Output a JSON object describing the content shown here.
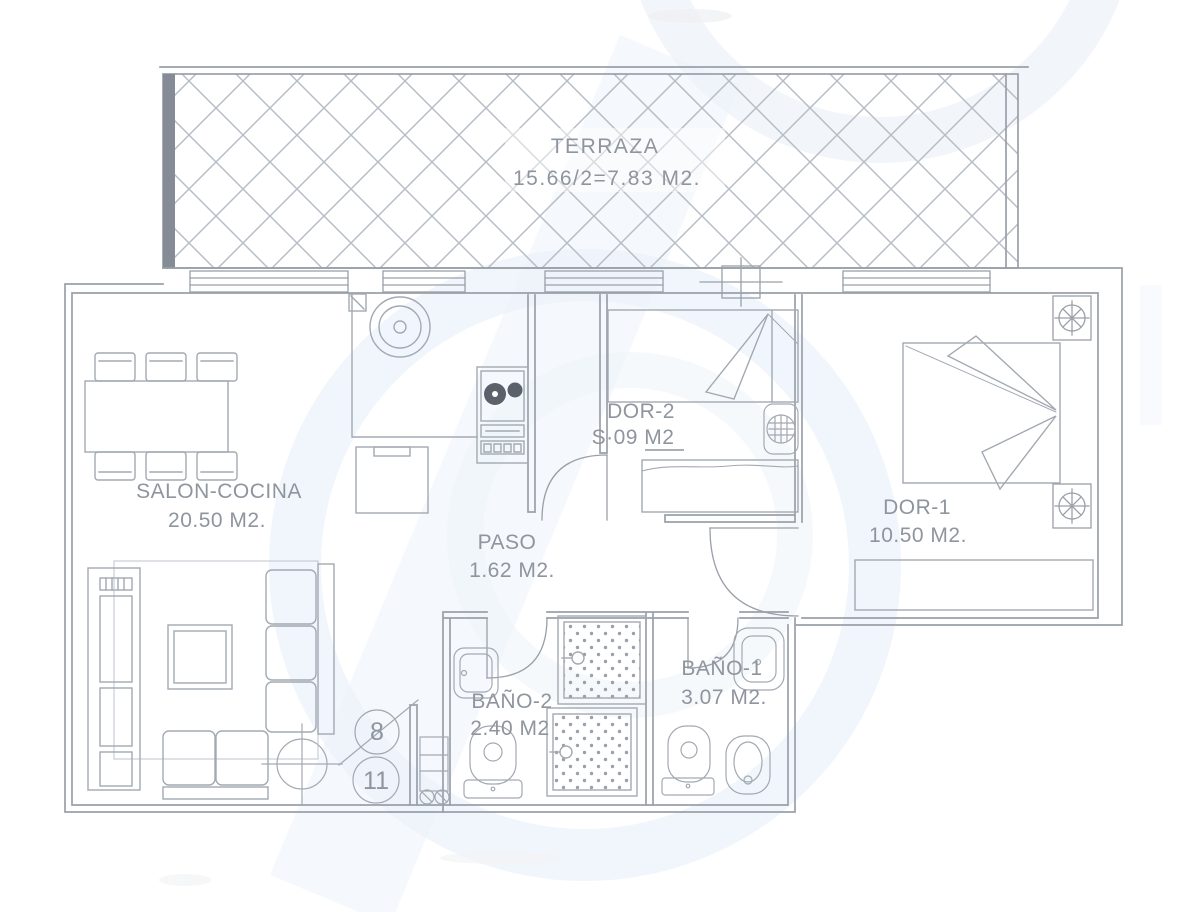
{
  "plan": {
    "type": "apartment-floor-plan",
    "rooms": [
      {
        "id": "terraza",
        "name": "TERRAZA",
        "area": "15.66/2=7.83 M2."
      },
      {
        "id": "salon-cocina",
        "name": "SALON-COCINA",
        "area": "20.50 M2."
      },
      {
        "id": "paso",
        "name": "PASO",
        "area": "1.62 M2."
      },
      {
        "id": "dor-2",
        "name": "DOR-2",
        "area": "S·09 M2"
      },
      {
        "id": "dor-1",
        "name": "DOR-1",
        "area": "10.50 M2."
      },
      {
        "id": "bano-2",
        "name": "BAÑO-2",
        "area": "2.40 M2"
      },
      {
        "id": "bano-1",
        "name": "BAÑO-1",
        "area": "3.07 M2."
      }
    ],
    "markers": [
      {
        "label": "8"
      },
      {
        "label": "11"
      }
    ],
    "fixtures": [
      "terrace-lattice",
      "window",
      "door-swing",
      "column-marker",
      "dining-table",
      "chair",
      "tv-unit",
      "rug",
      "coffee-table",
      "sofa",
      "ceiling-light",
      "kitchen-sink",
      "stove",
      "kitchen-cabinet",
      "single-bed",
      "double-bed",
      "wardrobe",
      "dresser",
      "nightstand-plant",
      "shower",
      "washbasin",
      "toilet",
      "bidet",
      "washer-column"
    ],
    "colors": {
      "line": "#9aa0a9",
      "text": "#8f959e",
      "hatch": "#b7bdc5",
      "wall_dark": "#868c95",
      "watermark": "#e0ebf6",
      "background": "#ffffff"
    }
  }
}
